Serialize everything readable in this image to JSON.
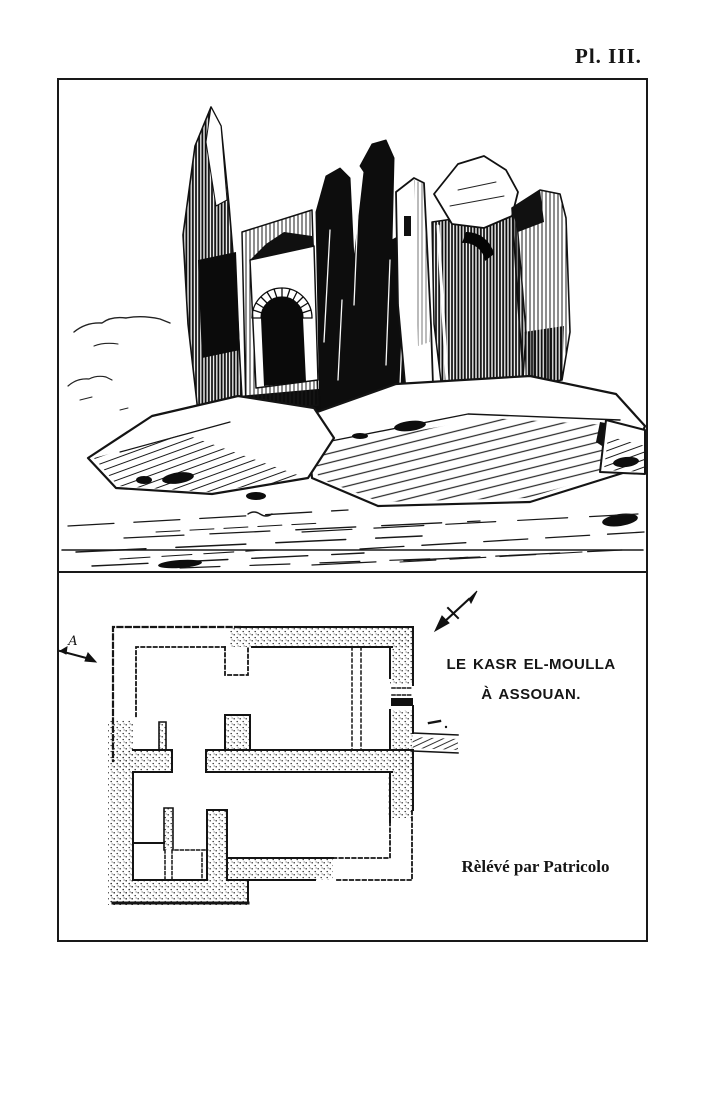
{
  "page": {
    "plate_label": "Pl. III.",
    "background_color": "#ffffff",
    "ink_color": "#1a1a1a"
  },
  "illustration": {
    "description": "Pen-and-ink view of the ruined walls of the Kasr el-Moulla standing on granite rocks",
    "elements": [
      "ruin-spires",
      "arched-doorway",
      "rock-outcrop",
      "clouds",
      "ground-hatching"
    ]
  },
  "plan": {
    "caption_line1": "LE KASR EL-MOULLA",
    "caption_line2": "À ASSOUAN.",
    "credit": "Rèlévé par Patricolo",
    "section_marker": "A",
    "icons": {
      "north_arrow": "north-arrow-icon",
      "section_arrow": "section-arrow-icon"
    },
    "legend": {
      "stippled_wall": "existing masonry",
      "dashed_line": "restored / ruined outline"
    }
  }
}
